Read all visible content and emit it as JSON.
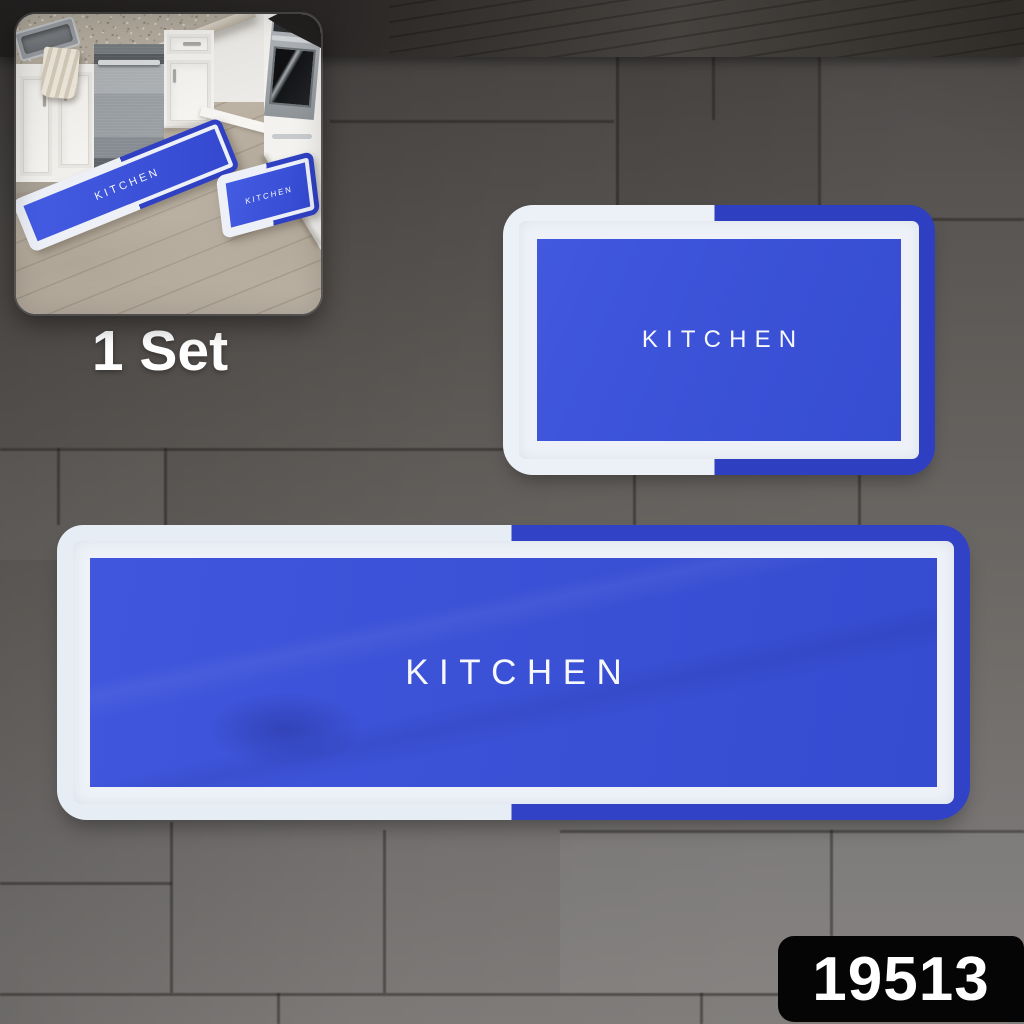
{
  "product": {
    "code": "19513"
  },
  "inset": {
    "caption": "1 Set",
    "runner_label": "KITCHEN",
    "small_mat_label": "KITCHEN"
  },
  "mats": {
    "large": {
      "label": "KITCHEN"
    },
    "small": {
      "label": "KITCHEN"
    }
  },
  "colors": {
    "mat_center_blue": "#3b52d6",
    "mat_border_blue": "#2e3fc2",
    "mat_white": "#e9eef5",
    "badge_bg": "#050505",
    "badge_text": "#ffffff",
    "caption_text": "#ffffff"
  }
}
